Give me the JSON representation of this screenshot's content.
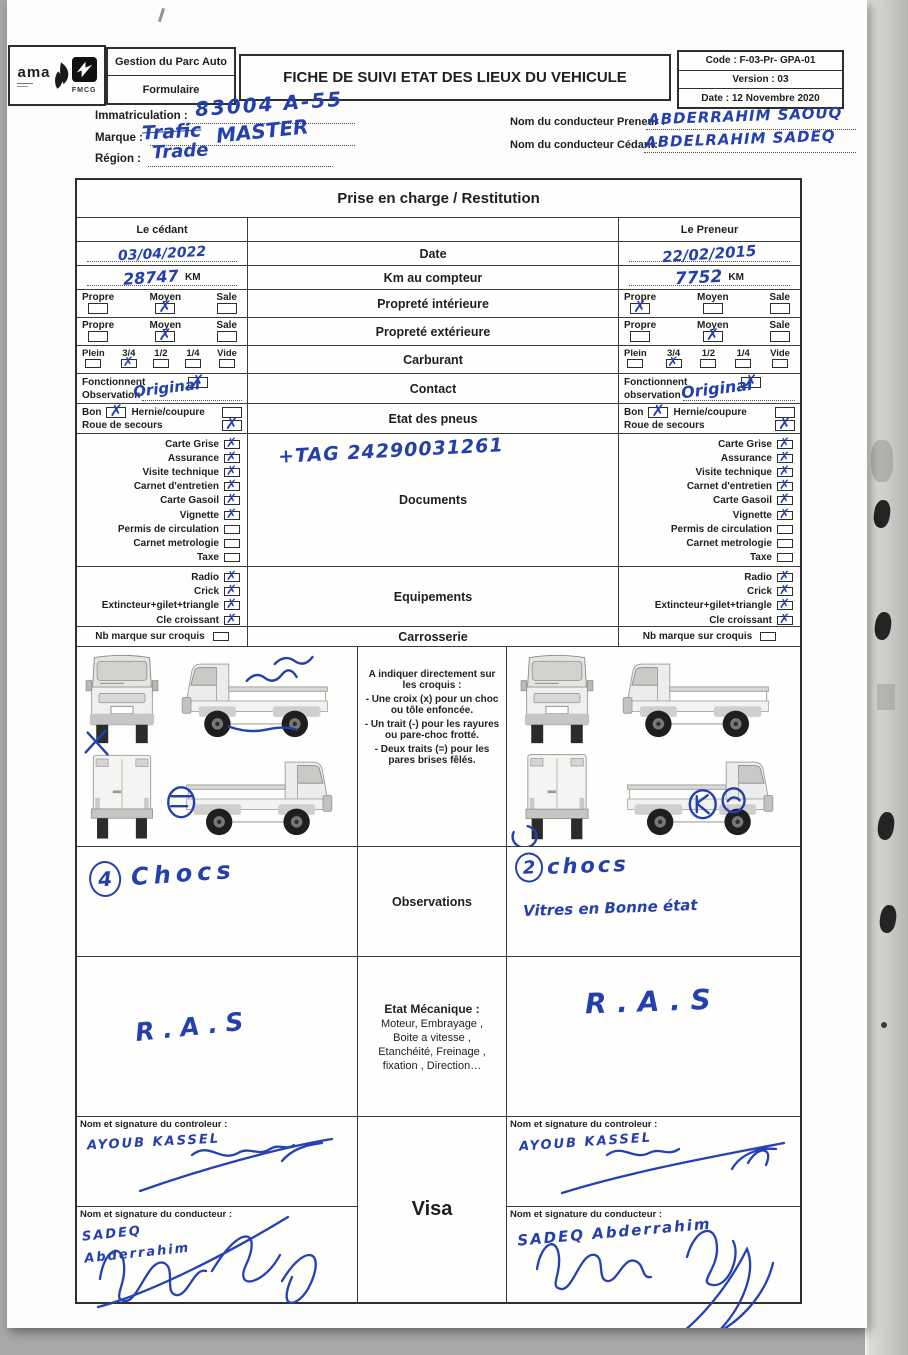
{
  "header": {
    "logo_text": "ama",
    "logo_sub": "FMCG",
    "dept": "Gestion du Parc Auto",
    "form_type": "Formulaire",
    "title": "FICHE DE SUIVI ETAT DES LIEUX DU VEHICULE",
    "code": "Code : F-03-Pr- GPA-01",
    "version": "Version : 03",
    "date": "Date : 12 Novembre 2020"
  },
  "info": {
    "immatriculation_label": "Immatriculation :",
    "immatriculation_value": "83004 A-55",
    "marque_label": "Marque :",
    "marque_struck": "Trafic",
    "marque_value": "MASTER",
    "region_label": "Région :",
    "region_value": "Trade",
    "preneur_label": "Nom du conducteur Preneur :",
    "preneur_value": "ABDERRAHIM SAOUQ",
    "cedant_label": "Nom du conducteur Cédant:",
    "cedant_value": "ABDELRAHIM SADEQ"
  },
  "table": {
    "title": "Prise en charge / Restitution",
    "col_cedant": "Le cédant",
    "col_preneur": "Le Preneur",
    "km_unit": "KM",
    "doc_note": "+TAG 24290031261",
    "labels": {
      "date": "Date",
      "km": "Km au compteur",
      "prop_int": "Propreté intérieure",
      "prop_ext": "Propreté extérieure",
      "carburant": "Carburant",
      "contact": "Contact",
      "pneus": "Etat des pneus",
      "documents": "Documents",
      "equipements": "Equipements",
      "carrosserie": "Carrosserie",
      "observations": "Observations",
      "visa": "Visa"
    },
    "proprete_options": [
      "Propre",
      "Moyen",
      "Sale"
    ],
    "carburant_options": [
      "Plein",
      "3/4",
      "1/2",
      "1/4",
      "Vide"
    ],
    "fonctionnent_label": "Fonctionnent",
    "observation_label": "Observation",
    "observation_label_lc": "observation",
    "bon_label": "Bon",
    "hernie_label": "Hernie/coupure",
    "roue_label": "Roue de secours",
    "documents_items": [
      "Carte Grise",
      "Assurance",
      "Visite technique",
      "Carnet d'entretien",
      "Carte Gasoil",
      "Vignette",
      "Permis de circulation",
      "Carnet metrologie",
      "Taxe"
    ],
    "equipements_items": [
      "Radio",
      "Crick",
      "Extincteur+gilet+triangle",
      "Cle croissant"
    ],
    "nb_marque_label": "Nb marque sur croquis",
    "croquis_instructions": [
      "A indiquer directement sur les croquis :",
      "- Une croix (x) pour un choc ou tôle enfoncée.",
      "- Un trait (-) pour les rayures ou pare-choc frotté.",
      "- Deux traits (=) pour les pares brises fêlés."
    ],
    "mecanique_title": "Etat Mécanique  :",
    "mecanique_lines": [
      "Moteur, Embrayage ,",
      "Boite a vitesse ,",
      "Etanchéité, Freinage ,",
      "fixation , Direction…"
    ],
    "controleur_label": "Nom et signature du controleur :",
    "conducteur_label": "Nom et signature du conducteur :"
  },
  "cedant": {
    "date": "03/04/2022",
    "km": "28747",
    "prop_int": [
      false,
      true,
      false
    ],
    "prop_ext": [
      false,
      true,
      false
    ],
    "carburant": [
      false,
      true,
      false,
      false,
      false
    ],
    "contact_ok": true,
    "contact_obs": "Original",
    "pneus_bon": true,
    "pneus_hernie": false,
    "pneus_roue": true,
    "documents": [
      true,
      true,
      true,
      true,
      true,
      true,
      false,
      false,
      false
    ],
    "equipements": [
      true,
      true,
      true,
      true
    ],
    "nb_marque": false,
    "obs_count": "4",
    "obs_word": "Chocs",
    "ras": "R.A.S",
    "controleur_name": "AYOUB KASSEL",
    "conducteur_name": "SADEQ Abderrahim"
  },
  "preneur": {
    "date": "22/02/2015",
    "km": "7752",
    "prop_int": [
      true,
      false,
      false
    ],
    "prop_ext": [
      false,
      true,
      false
    ],
    "carburant": [
      false,
      true,
      false,
      false,
      false
    ],
    "contact_ok": true,
    "contact_obs": "Original",
    "pneus_bon": true,
    "pneus_hernie": false,
    "pneus_roue": true,
    "documents": [
      true,
      true,
      true,
      true,
      true,
      true,
      false,
      false,
      false
    ],
    "equipements": [
      true,
      true,
      true,
      true
    ],
    "nb_marque": false,
    "obs_count": "2",
    "obs_word": "chocs",
    "obs_extra": "Vitres en Bonne état",
    "ras": "R.A.S",
    "controleur_name": "AYOUB KASSEL",
    "conducteur_name": "SADEQ Abderrahim"
  },
  "colors": {
    "ink": "#2440ae"
  }
}
